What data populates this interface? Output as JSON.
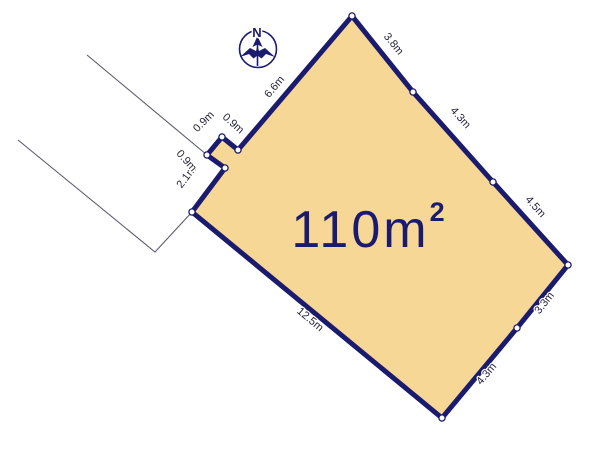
{
  "diagram": {
    "type": "land-plot-diagram",
    "area": {
      "text": "110m",
      "sup": "2"
    },
    "compass": {
      "label": "N"
    },
    "colors": {
      "parcel_fill": "#f7d795",
      "parcel_border": "#1a1a6e",
      "dimension_text": "#26263c",
      "area_text": "#1a1a6e",
      "thin_line": "#5c5c72",
      "marker_fill": "#ffffff"
    },
    "parcel_vertices": [
      [
        352,
        16
      ],
      [
        413,
        92
      ],
      [
        493,
        182
      ],
      [
        568,
        265
      ],
      [
        517,
        328
      ],
      [
        442,
        418
      ],
      [
        192,
        212
      ],
      [
        225,
        168
      ],
      [
        207,
        155
      ],
      [
        222,
        137
      ],
      [
        238,
        150
      ]
    ],
    "boundary_lines": [
      [
        [
          87,
          55
        ],
        [
          207,
          155
        ]
      ],
      [
        [
          18,
          140
        ],
        [
          155,
          252
        ],
        [
          192,
          212
        ]
      ]
    ],
    "dimensions": [
      {
        "label": "3.8m",
        "x": 391,
        "y": 46,
        "rotate": 51
      },
      {
        "label": "4.3m",
        "x": 458,
        "y": 120,
        "rotate": 48
      },
      {
        "label": "4.5m",
        "x": 533,
        "y": 209,
        "rotate": 48
      },
      {
        "label": "3.3m",
        "x": 547,
        "y": 305,
        "rotate": -52
      },
      {
        "label": "4.3m",
        "x": 489,
        "y": 376,
        "rotate": -50
      },
      {
        "label": "12.5m",
        "x": 308,
        "y": 322,
        "rotate": 40
      },
      {
        "label": "2.1m",
        "x": 189,
        "y": 179,
        "rotate": -53
      },
      {
        "label": "0.9m",
        "x": 184,
        "y": 163,
        "rotate": 48
      },
      {
        "label": "0.9m",
        "x": 206,
        "y": 124,
        "rotate": -45
      },
      {
        "label": "0.9m",
        "x": 231,
        "y": 126,
        "rotate": 42
      },
      {
        "label": "6.6m",
        "x": 277,
        "y": 89,
        "rotate": -50
      }
    ]
  }
}
